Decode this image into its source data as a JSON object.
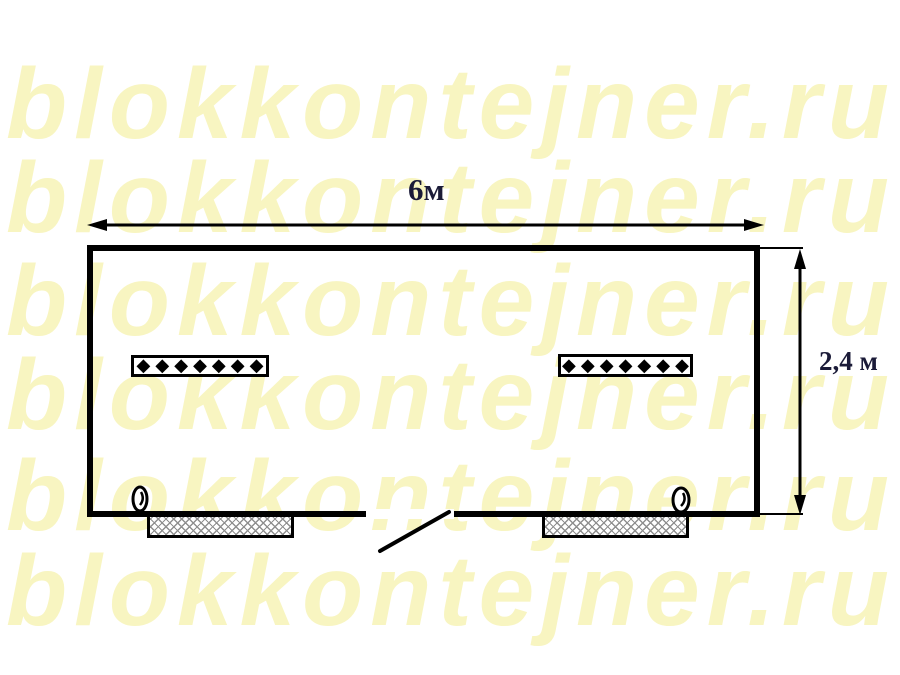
{
  "watermark": {
    "text": "blokkontejner.ru",
    "color": "#f8f5c1"
  },
  "dimensions": {
    "width_label": "6м",
    "height_label": "2,4 м",
    "label_color": "#1b1b38"
  },
  "plan": {
    "shape": "rectangle",
    "line_color": "#000000",
    "door": {
      "position": "bottom-center",
      "swing": "outward-left"
    },
    "windows": [
      {
        "position": "bottom-left",
        "fill": "crosshatch"
      },
      {
        "position": "bottom-right",
        "fill": "crosshatch"
      }
    ],
    "radiators": [
      {
        "segments": "◆◆◆◆◆◆◆"
      },
      {
        "segments": "◆◆◆◆◆◆◆"
      }
    ],
    "lamps": [
      {
        "position": "left-of-left-window"
      },
      {
        "position": "right-end-of-right-window"
      }
    ]
  }
}
